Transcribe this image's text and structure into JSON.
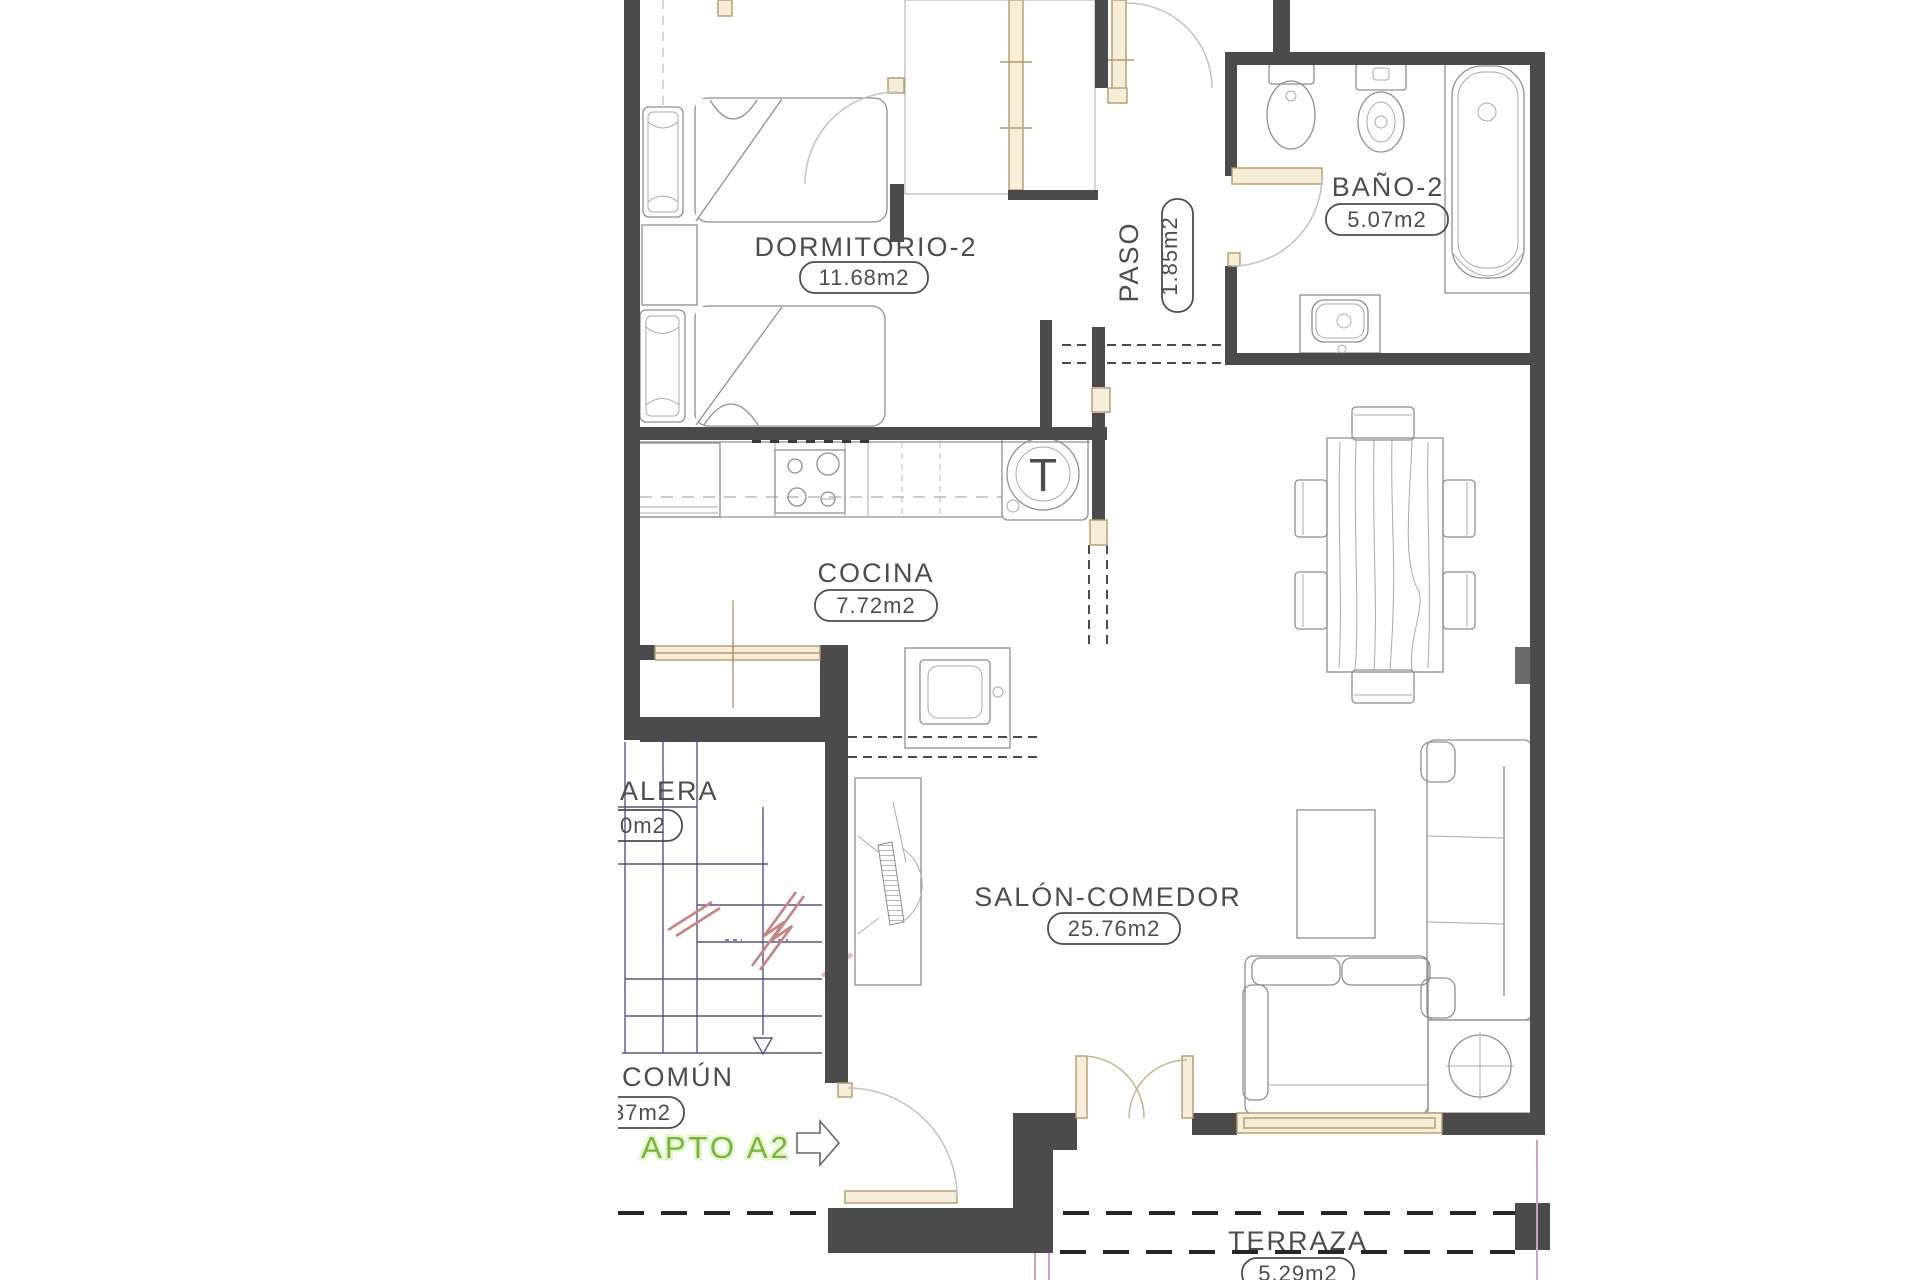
{
  "floor_plan": {
    "apartment": {
      "label": "APTO A2"
    },
    "rooms": {
      "dormitorio": {
        "name": "DORMITORIO-2",
        "area": "11.68m2"
      },
      "bano": {
        "name": "BAÑO-2",
        "area": "5.07m2"
      },
      "paso": {
        "name": "PASO",
        "area": "1.85m2"
      },
      "cocina": {
        "name": "COCINA",
        "area": "7.72m2"
      },
      "salon": {
        "name": "SALÓN-COMEDOR",
        "area": "25.76m2"
      },
      "terraza": {
        "name": "TERRAZA",
        "area": "5.29m2"
      },
      "escalera": {
        "name_visible": "ALERA",
        "area_visible": "0m2"
      },
      "comun": {
        "name_visible": "COMÚN",
        "area_visible": "37m2"
      }
    },
    "markers": {
      "water_heater": "T"
    },
    "colors": {
      "wall": "#4b4b4b",
      "stair_blue": "#55558c",
      "accent_green": "#76b82f",
      "joinery_tan": "#b59a6a",
      "break_red": "#c98383",
      "crop_pink": "#cf9ecb"
    }
  }
}
